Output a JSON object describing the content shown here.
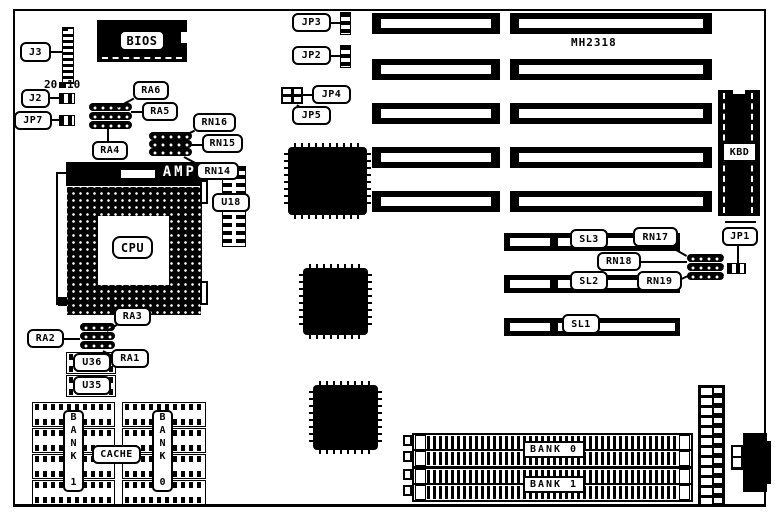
{
  "board": {
    "id_text": "MH2318",
    "colors": {
      "ink": "#000000",
      "paper": "#ffffff"
    }
  },
  "labels": {
    "j3": "J3",
    "j3_pin_left": "20",
    "j3_pin_right": "10",
    "j2": "J2",
    "jp7": "JP7",
    "bios": "BIOS",
    "ra6": "RA6",
    "ra5": "RA5",
    "ra4": "RA4",
    "rn16": "RN16",
    "rn15": "RN15",
    "rn14": "RN14",
    "socket_brand": "AMP",
    "u18": "U18",
    "cpu": "CPU",
    "ra3": "RA3",
    "ra2": "RA2",
    "ra1": "RA1",
    "u36": "U36",
    "u35": "U35",
    "cache": "CACHE",
    "cache_bank_left": "BANK 1",
    "cache_bank_right": "BANK 0",
    "jp3": "JP3",
    "jp2": "JP2",
    "jp4": "JP4",
    "jp5": "JP5",
    "jp1": "JP1",
    "kbd": "KBD",
    "sl3": "SL3",
    "sl2": "SL2",
    "sl1": "SL1",
    "rn17": "RN17",
    "rn18": "RN18",
    "rn19": "RN19",
    "simm_bank0": "BANK 0",
    "simm_bank1": "BANK 1"
  }
}
